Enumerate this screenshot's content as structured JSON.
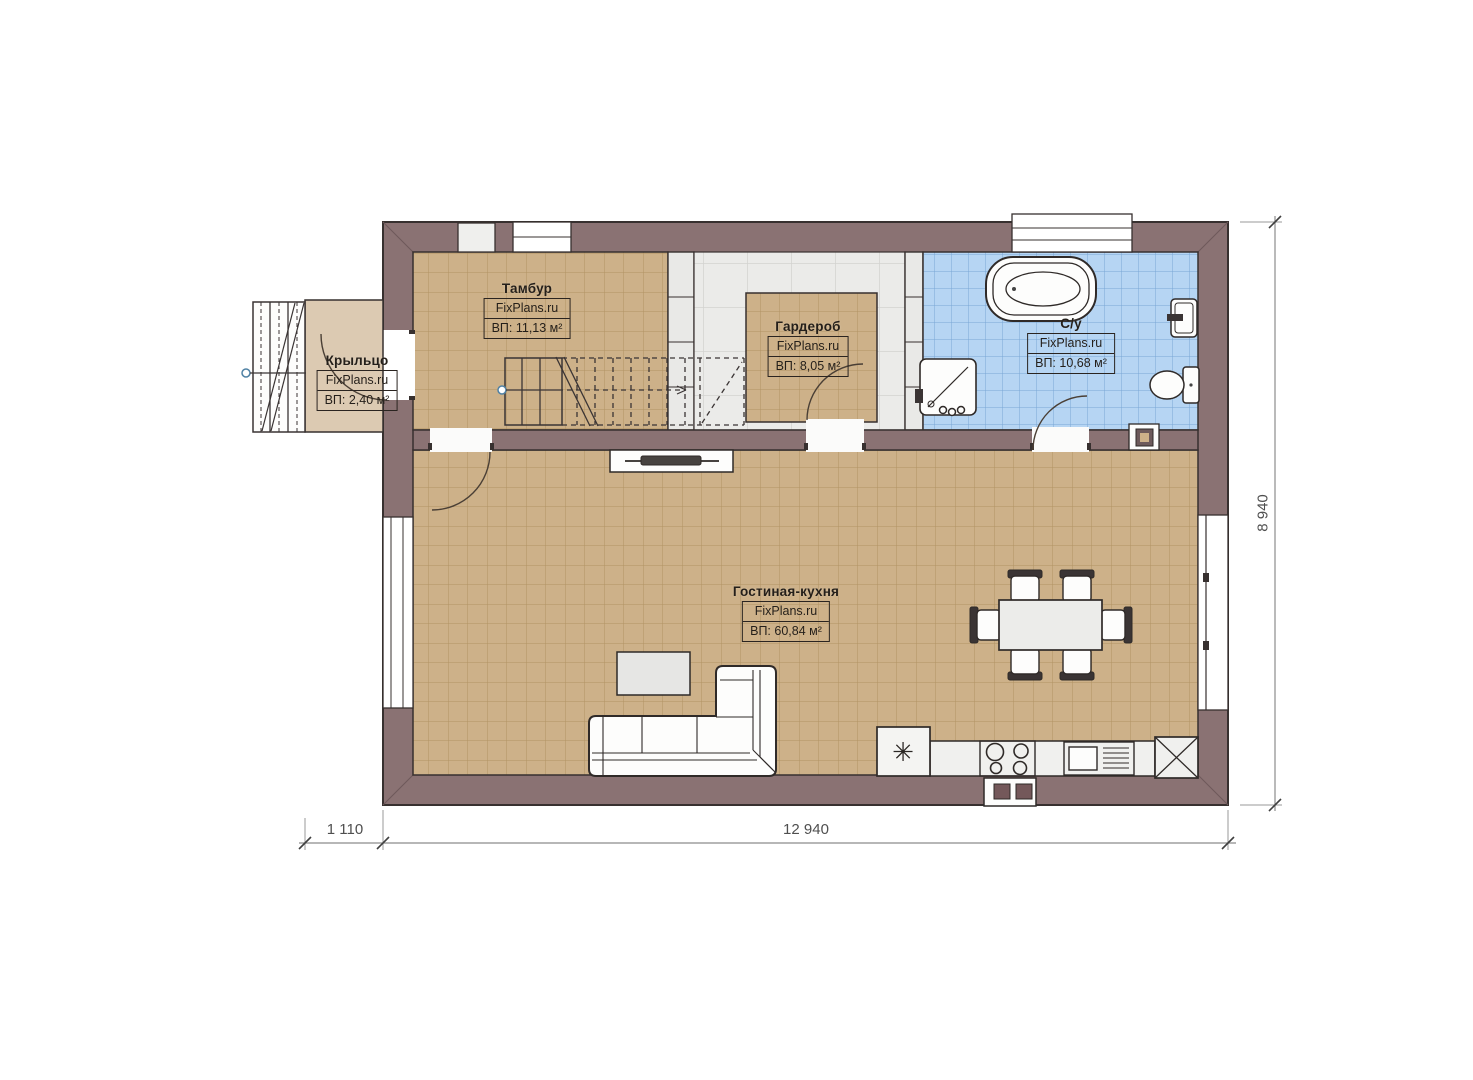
{
  "plan": {
    "rooms": [
      {
        "name": "Тамбур",
        "brand": "FixPlans.ru",
        "area": "ВП: 11,13 м²"
      },
      {
        "name": "Гардероб",
        "brand": "FixPlans.ru",
        "area": "ВП: 8,05 м²"
      },
      {
        "name": "С/у",
        "brand": "FixPlans.ru",
        "area": "ВП: 10,68 м²"
      },
      {
        "name": "Крыльцо",
        "brand": "FixPlans.ru",
        "area": "ВП: 2,40 м²"
      },
      {
        "name": "Гостиная-кухня",
        "brand": "FixPlans.ru",
        "area": "ВП: 60,84 м²"
      }
    ],
    "dimensions": {
      "porch_depth": "1 110",
      "house_width": "12 940",
      "house_depth": "8 940"
    },
    "symbols": {
      "fridge": "✳"
    },
    "colors": {
      "wall": "#8a7273",
      "floor_tile_tan": "#cdb189",
      "floor_tile_blue": "#b6d5f3",
      "partition": "#e9e9e7",
      "porch_floor": "#dccab2",
      "outline": "#37302f",
      "dimension_text": "#4f4f4f"
    }
  }
}
